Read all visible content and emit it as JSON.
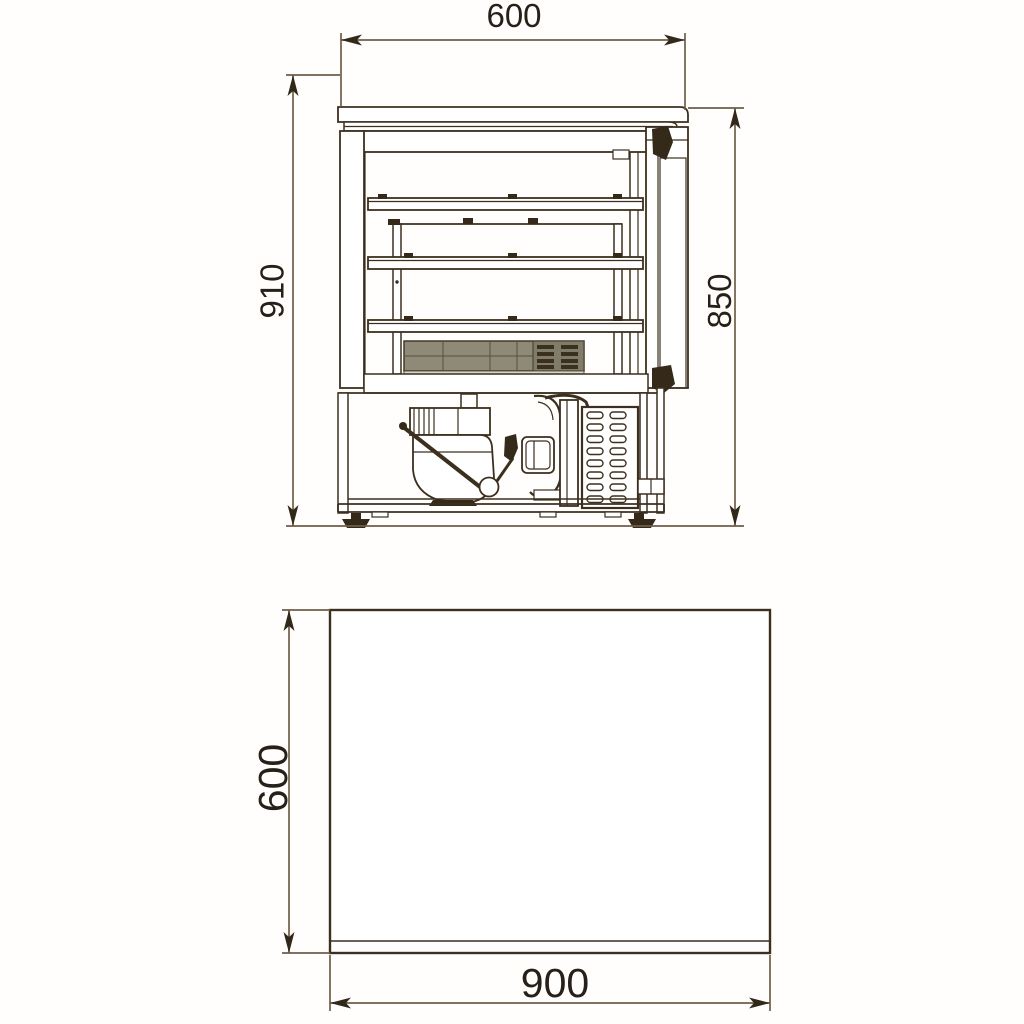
{
  "drawing": {
    "type": "technical-dimension-drawing",
    "subject": "refrigerated-counter-cross-section-and-plan",
    "views": {
      "side_view": {
        "name": "front-section-view",
        "dim_top_width": "600",
        "dim_left_height": "910",
        "dim_right_height": "850"
      },
      "plan_view": {
        "name": "top-plan-view",
        "dim_left_depth": "600",
        "dim_bottom_width": "900"
      }
    },
    "colors": {
      "background": "#ffffff",
      "outline": "#3c2f1e",
      "dimension_line": "#6e5e48",
      "arrow": "#32281a",
      "label_text": "#262019",
      "evaporator_fill": "#8f8977"
    }
  }
}
